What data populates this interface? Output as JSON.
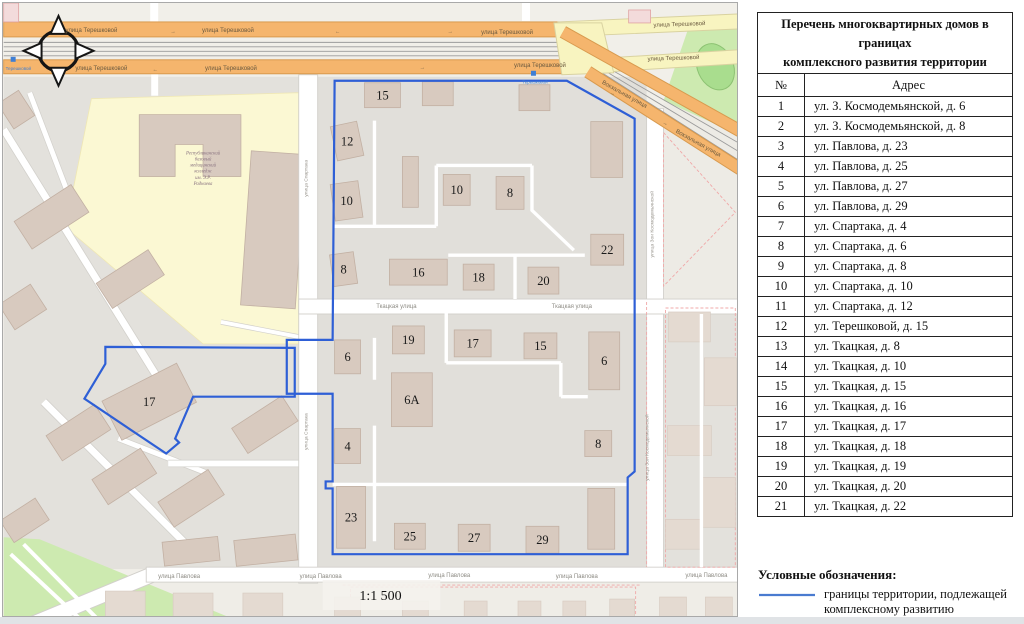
{
  "map": {
    "boundary_color": "#2e5fd6",
    "scale_label": "1:1 500",
    "college_label_lines": [
      "Республиканский",
      "базовый",
      "медицинский",
      "колледж",
      "им. Э.Р.",
      "Раднаева"
    ],
    "stop_label": "Терешковой",
    "stops": [
      [
        9,
        56
      ],
      [
        531,
        70
      ]
    ],
    "street_labels": [
      {
        "t": "улица Терешковой",
        "x": 88,
        "y": 29,
        "r": 0,
        "c": "road"
      },
      {
        "t": "улица Терешковой",
        "x": 225,
        "y": 29,
        "r": 0,
        "c": "road"
      },
      {
        "t": "улица Терешковой",
        "x": 505,
        "y": 31,
        "r": 0,
        "c": "road"
      },
      {
        "t": "улица Терешковой",
        "x": 678,
        "y": 23,
        "r": -2,
        "c": "road"
      },
      {
        "t": "улица Терешковой",
        "x": 98,
        "y": 67,
        "r": 0,
        "c": "road"
      },
      {
        "t": "улица Терешковой",
        "x": 228,
        "y": 67,
        "r": 0,
        "c": "road"
      },
      {
        "t": "улица Терешковой",
        "x": 538,
        "y": 64,
        "r": 0,
        "c": "road"
      },
      {
        "t": "улица Терешковой",
        "x": 672,
        "y": 57,
        "r": -2,
        "c": "road"
      },
      {
        "t": "Вокзальная улица",
        "x": 622,
        "y": 93,
        "r": 29,
        "c": "road"
      },
      {
        "t": "Вокзальная улица",
        "x": 696,
        "y": 142,
        "r": 29,
        "c": "road"
      },
      {
        "t": "Ткацкая улица",
        "x": 394,
        "y": 306,
        "r": 0,
        "c": "white"
      },
      {
        "t": "Ткацкая улица",
        "x": 570,
        "y": 306,
        "r": 0,
        "c": "white"
      },
      {
        "t": "улица Павлова",
        "x": 176,
        "y": 577,
        "r": 0,
        "c": "white"
      },
      {
        "t": "улица Павлова",
        "x": 318,
        "y": 577,
        "r": 0,
        "c": "white"
      },
      {
        "t": "улица Павлова",
        "x": 447,
        "y": 576,
        "r": 0,
        "c": "white"
      },
      {
        "t": "улица Павлова",
        "x": 575,
        "y": 577,
        "r": 0,
        "c": "white"
      },
      {
        "t": "улица Павлова",
        "x": 705,
        "y": 576,
        "r": 0,
        "c": "white"
      },
      {
        "t": "улица Спартака",
        "x": 305,
        "y": 176,
        "r": -90,
        "c": "vert"
      },
      {
        "t": "улица Спартака",
        "x": 305,
        "y": 430,
        "r": -90,
        "c": "vert"
      },
      {
        "t": "улица Зои Космодемьянской",
        "x": 652,
        "y": 222,
        "r": -90,
        "c": "vert"
      },
      {
        "t": "улица Зои Космодемьянской",
        "x": 647,
        "y": 446,
        "r": -90,
        "c": "vert"
      }
    ],
    "road_arrows": [
      {
        "x": 62,
        "y": 30,
        "ch": "←",
        "r": 0
      },
      {
        "x": 170,
        "y": 30,
        "ch": "→",
        "r": 0
      },
      {
        "x": 335,
        "y": 30,
        "ch": "←",
        "r": 0
      },
      {
        "x": 448,
        "y": 30,
        "ch": "→",
        "r": 0
      },
      {
        "x": 152,
        "y": 68,
        "ch": "←",
        "r": 0
      },
      {
        "x": 420,
        "y": 66,
        "ch": "→",
        "r": 0
      },
      {
        "x": 610,
        "y": 92,
        "ch": "→",
        "r": 29
      },
      {
        "x": 663,
        "y": 122,
        "ch": "→",
        "r": 29
      }
    ],
    "buildings_labeled": [
      {
        "n": "15",
        "x": 362,
        "y": 80,
        "w": 36,
        "h": 25,
        "r": 0
      },
      {
        "n": "12",
        "x": 331,
        "y": 121,
        "w": 27,
        "h": 35,
        "r": -12
      },
      {
        "n": "10",
        "x": 330,
        "y": 180,
        "w": 28,
        "h": 37,
        "r": -8
      },
      {
        "n": "10",
        "x": 441,
        "y": 172,
        "w": 27,
        "h": 31,
        "r": 0
      },
      {
        "n": "8",
        "x": 494,
        "y": 174,
        "w": 28,
        "h": 33,
        "r": 0
      },
      {
        "n": "8",
        "x": 329,
        "y": 251,
        "w": 24,
        "h": 32,
        "r": -8
      },
      {
        "n": "16",
        "x": 387,
        "y": 257,
        "w": 58,
        "h": 26,
        "r": 0
      },
      {
        "n": "18",
        "x": 461,
        "y": 262,
        "w": 31,
        "h": 26,
        "r": 0
      },
      {
        "n": "20",
        "x": 526,
        "y": 265,
        "w": 31,
        "h": 27,
        "r": 0
      },
      {
        "n": "22",
        "x": 589,
        "y": 232,
        "w": 33,
        "h": 31,
        "r": 0
      },
      {
        "n": "6",
        "x": 332,
        "y": 338,
        "w": 26,
        "h": 34,
        "r": 0
      },
      {
        "n": "19",
        "x": 390,
        "y": 324,
        "w": 32,
        "h": 28,
        "r": 0
      },
      {
        "n": "17",
        "x": 452,
        "y": 328,
        "w": 37,
        "h": 27,
        "r": 0
      },
      {
        "n": "15",
        "x": 522,
        "y": 331,
        "w": 33,
        "h": 26,
        "r": 0
      },
      {
        "n": "6",
        "x": 587,
        "y": 330,
        "w": 31,
        "h": 58,
        "r": 0
      },
      {
        "n": "6А",
        "x": 389,
        "y": 371,
        "w": 41,
        "h": 54,
        "r": 0
      },
      {
        "n": "4",
        "x": 332,
        "y": 427,
        "w": 26,
        "h": 35,
        "r": 0
      },
      {
        "n": "8",
        "x": 583,
        "y": 429,
        "w": 27,
        "h": 26,
        "r": 0
      },
      {
        "n": "23",
        "x": 334,
        "y": 485,
        "w": 29,
        "h": 62,
        "r": 0
      },
      {
        "n": "25",
        "x": 392,
        "y": 522,
        "w": 31,
        "h": 26,
        "r": 0
      },
      {
        "n": "27",
        "x": 456,
        "y": 523,
        "w": 32,
        "h": 27,
        "r": 0
      },
      {
        "n": "29",
        "x": 524,
        "y": 525,
        "w": 33,
        "h": 27,
        "r": 0
      },
      {
        "n": "17",
        "x": 104,
        "y": 378,
        "w": 84,
        "h": 44,
        "r": -27
      }
    ],
    "buildings_unlabeled": [
      [
        420,
        79,
        31,
        24,
        0
      ],
      [
        517,
        82,
        31,
        26,
        0
      ],
      [
        589,
        119,
        32,
        56,
        0
      ],
      [
        400,
        154,
        16,
        51,
        0
      ],
      [
        586,
        487,
        27,
        61,
        0
      ],
      [
        14,
        198,
        68,
        33,
        -33
      ],
      [
        96,
        262,
        62,
        30,
        -33
      ],
      [
        0,
        290,
        38,
        30,
        -33
      ],
      [
        0,
        92,
        25,
        30,
        -33
      ],
      [
        46,
        416,
        58,
        30,
        -33
      ],
      [
        92,
        460,
        58,
        30,
        -33
      ],
      [
        158,
        482,
        60,
        30,
        -33
      ],
      [
        232,
        408,
        60,
        30,
        -33
      ],
      [
        0,
        506,
        42,
        26,
        -33
      ],
      [
        160,
        538,
        56,
        24,
        -6
      ],
      [
        232,
        536,
        62,
        26,
        -6
      ]
    ],
    "buildings_faded": [
      [
        667,
        310,
        42,
        30,
        0
      ],
      [
        703,
        356,
        32,
        48,
        0
      ],
      [
        666,
        424,
        44,
        30,
        0
      ],
      [
        700,
        476,
        34,
        50,
        0
      ],
      [
        664,
        518,
        36,
        30,
        0
      ],
      [
        102,
        590,
        40,
        26,
        0
      ],
      [
        170,
        592,
        40,
        26,
        0
      ],
      [
        240,
        592,
        40,
        26,
        0
      ],
      [
        332,
        596,
        26,
        20,
        0
      ],
      [
        400,
        600,
        26,
        16,
        0
      ],
      [
        462,
        600,
        23,
        16,
        0
      ],
      [
        516,
        600,
        23,
        16,
        0
      ],
      [
        561,
        600,
        23,
        16,
        0
      ],
      [
        608,
        598,
        25,
        18,
        0
      ],
      [
        658,
        596,
        27,
        20,
        0
      ],
      [
        704,
        596,
        27,
        20,
        0
      ]
    ]
  },
  "table": {
    "title_line1": "Перечень многоквартирных домов в границах",
    "title_line2": "комплексного развития территории",
    "col_num": "№",
    "col_addr": "Адрес",
    "rows": [
      {
        "n": "1",
        "a": "ул. З. Космодемьянской, д. 6"
      },
      {
        "n": "2",
        "a": "ул. З. Космодемьянской, д. 8"
      },
      {
        "n": "3",
        "a": "ул. Павлова, д. 23"
      },
      {
        "n": "4",
        "a": "ул. Павлова, д. 25"
      },
      {
        "n": "5",
        "a": "ул. Павлова, д. 27"
      },
      {
        "n": "6",
        "a": "ул. Павлова, д. 29"
      },
      {
        "n": "7",
        "a": "ул. Спартака, д. 4"
      },
      {
        "n": "8",
        "a": "ул. Спартака, д. 6"
      },
      {
        "n": "9",
        "a": "ул. Спартака, д. 8"
      },
      {
        "n": "10",
        "a": "ул. Спартака, д. 10"
      },
      {
        "n": "11",
        "a": "ул. Спартака, д. 12"
      },
      {
        "n": "12",
        "a": "ул. Терешковой, д. 15"
      },
      {
        "n": "13",
        "a": "ул. Ткацкая, д. 8"
      },
      {
        "n": "14",
        "a": "ул. Ткацкая, д. 10"
      },
      {
        "n": "15",
        "a": "ул. Ткацкая, д. 15"
      },
      {
        "n": "16",
        "a": "ул. Ткацкая, д. 16"
      },
      {
        "n": "17",
        "a": "ул. Ткацкая, д. 17"
      },
      {
        "n": "18",
        "a": "ул. Ткацкая, д. 18"
      },
      {
        "n": "19",
        "a": "ул. Ткацкая, д. 19"
      },
      {
        "n": "20",
        "a": "ул. Ткацкая, д. 20"
      },
      {
        "n": "21",
        "a": "ул. Ткацкая, д. 22"
      }
    ]
  },
  "legend": {
    "heading": "Условные обозначения:",
    "item_line1": "границы территории, подлежащей",
    "item_line2": "комплексному развитию",
    "line_color": "#4a7bd0"
  }
}
